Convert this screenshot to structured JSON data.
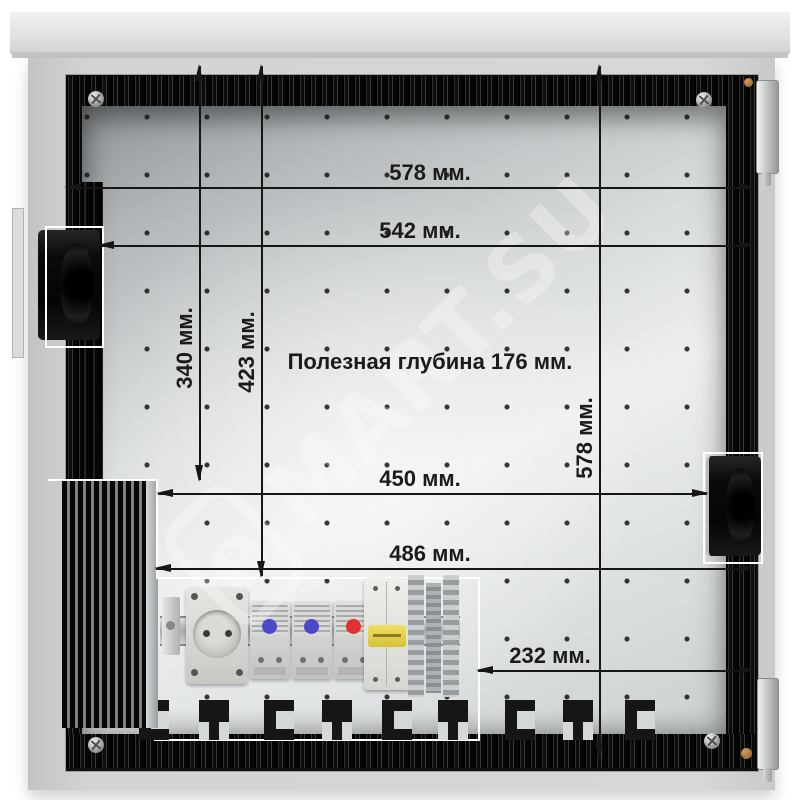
{
  "dims": {
    "d578_top": "578 мм.",
    "d542": "542 мм.",
    "d340": "340 мм.",
    "d423": "423 мм.",
    "d578_right": "578 мм.",
    "d450": "450 мм.",
    "d486": "486 мм.",
    "d232": "232 мм.",
    "depth_note": "Полезная глубина 176 мм."
  },
  "watermark": {
    "logo_letter": "e",
    "text": "MART.SU"
  },
  "colors": {
    "dimension_line": "#161616",
    "annotation_outline": "#ffffff",
    "plate_light": "#edeff0",
    "plate_dark": "#8f9396",
    "gasket_black": "#0b0b0b",
    "cabinet_gray": "#d4d6d4",
    "thermostat_knob_blue": "#4a4ac8",
    "thermostat_knob_red": "#e03030",
    "breaker_lever_yellow": "#e8d24a"
  },
  "equipment": [
    "left-fan",
    "right-fan",
    "heatsink",
    "din-rail",
    "schuko-socket",
    "thermostat-blue",
    "thermostat-blue",
    "thermostat-red",
    "circuit-breaker",
    "terminal-blocks",
    "cable-knockouts"
  ]
}
